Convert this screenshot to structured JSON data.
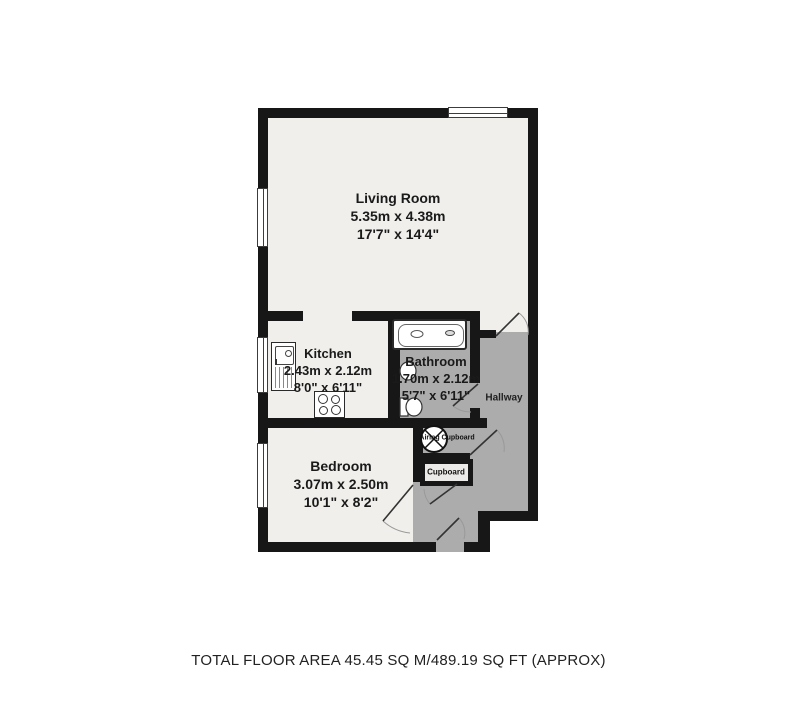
{
  "plan": {
    "title": "Flat floor plan",
    "rooms": [
      {
        "id": "living_room",
        "name": "Living Room",
        "metric": "5.35m x 4.38m",
        "imperial": "17'7\" x 14'4\""
      },
      {
        "id": "kitchen",
        "name": "Kitchen",
        "metric": "2.43m x 2.12m",
        "imperial": "8'0\" x 6'11\""
      },
      {
        "id": "bathroom",
        "name": "Bathroom",
        "metric": "1.70m x 2.12m",
        "imperial": "5'7\" x 6'11\""
      },
      {
        "id": "bedroom",
        "name": "Bedroom",
        "metric": "3.07m x 2.50m",
        "imperial": "10'1\" x 8'2\""
      },
      {
        "id": "hallway",
        "name": "Hallway"
      },
      {
        "id": "airing_cupboard",
        "name": "Airing Cupboard"
      },
      {
        "id": "cupboard",
        "name": "Cupboard"
      }
    ],
    "fixtures": [
      "bathtub",
      "bathroom-sink",
      "toilet",
      "kitchen-sink",
      "hob",
      "hot-water-cylinder"
    ],
    "footer": "TOTAL FLOOR AREA 45.45 SQ M/489.19 SQ FT (APPROX)",
    "colors": {
      "wall": "#171717",
      "room_floor": "#f0efec",
      "corridor_floor": "#acacac",
      "fixture_fill": "#ffffff",
      "background": "#ffffff"
    }
  }
}
